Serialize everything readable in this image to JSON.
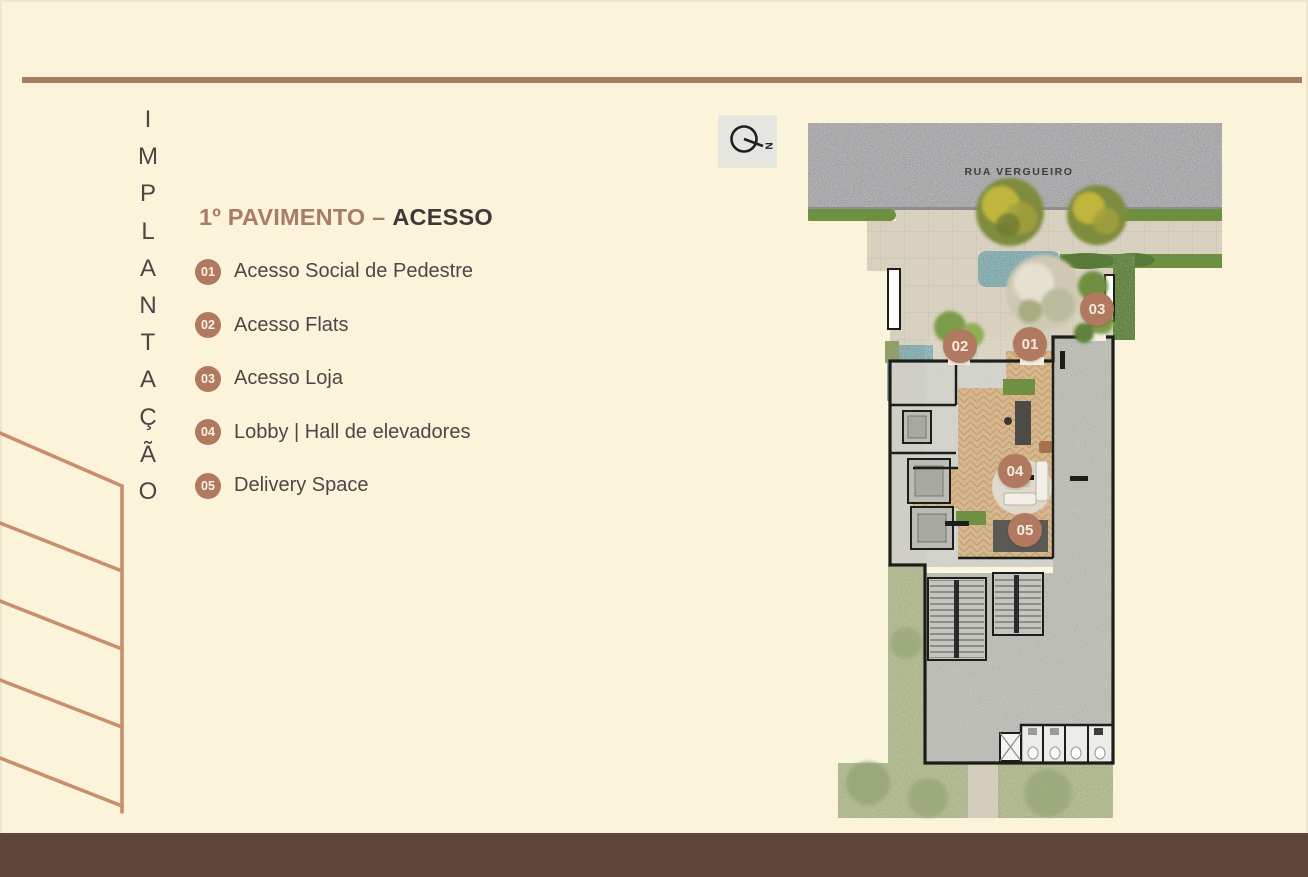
{
  "slide": {
    "vertical_label": "IMPLANTAÇÃO",
    "title": {
      "prefix": "1º PAVIMENTO –",
      "emphasis": "ACESSO"
    },
    "legend": {
      "items": [
        {
          "num": "01",
          "label": "Acesso Social de Pedestre"
        },
        {
          "num": "02",
          "label": "Acesso Flats"
        },
        {
          "num": "03",
          "label": "Acesso Loja"
        },
        {
          "num": "04",
          "label": "Lobby | Hall de elevadores"
        },
        {
          "num": "05",
          "label": "Delivery Space"
        }
      ]
    }
  },
  "plan": {
    "street_label": "RUA VERGUEIRO",
    "compass": {
      "icon": "north-arrow-icon",
      "letter": "N"
    },
    "markers": [
      {
        "label": "01",
        "x": 222,
        "y": 221
      },
      {
        "label": "02",
        "x": 152,
        "y": 223
      },
      {
        "label": "03",
        "x": 289,
        "y": 186
      },
      {
        "label": "04",
        "x": 207,
        "y": 348
      },
      {
        "label": "05",
        "x": 217,
        "y": 407
      }
    ]
  },
  "theme": {
    "bg": "#fbf4da",
    "topline": "#a67d60",
    "footer": "#5e4737",
    "accent": "#b17a60",
    "title_accent": "#a87b6a",
    "text": "#4a4646",
    "deco_line": "#c98e6d",
    "street_gray": "#a0a0a2",
    "sidewalk": "#d8d1c0",
    "grass": "#6d9140",
    "hedge": "#587a38",
    "garden": "#a9b388",
    "floor_gray": "#cfcfc8",
    "store_gray": "#b7b8b0",
    "wood": "#d7b78d",
    "wall": "#1d1d1b",
    "teal_bed": "#7ba4a5"
  }
}
